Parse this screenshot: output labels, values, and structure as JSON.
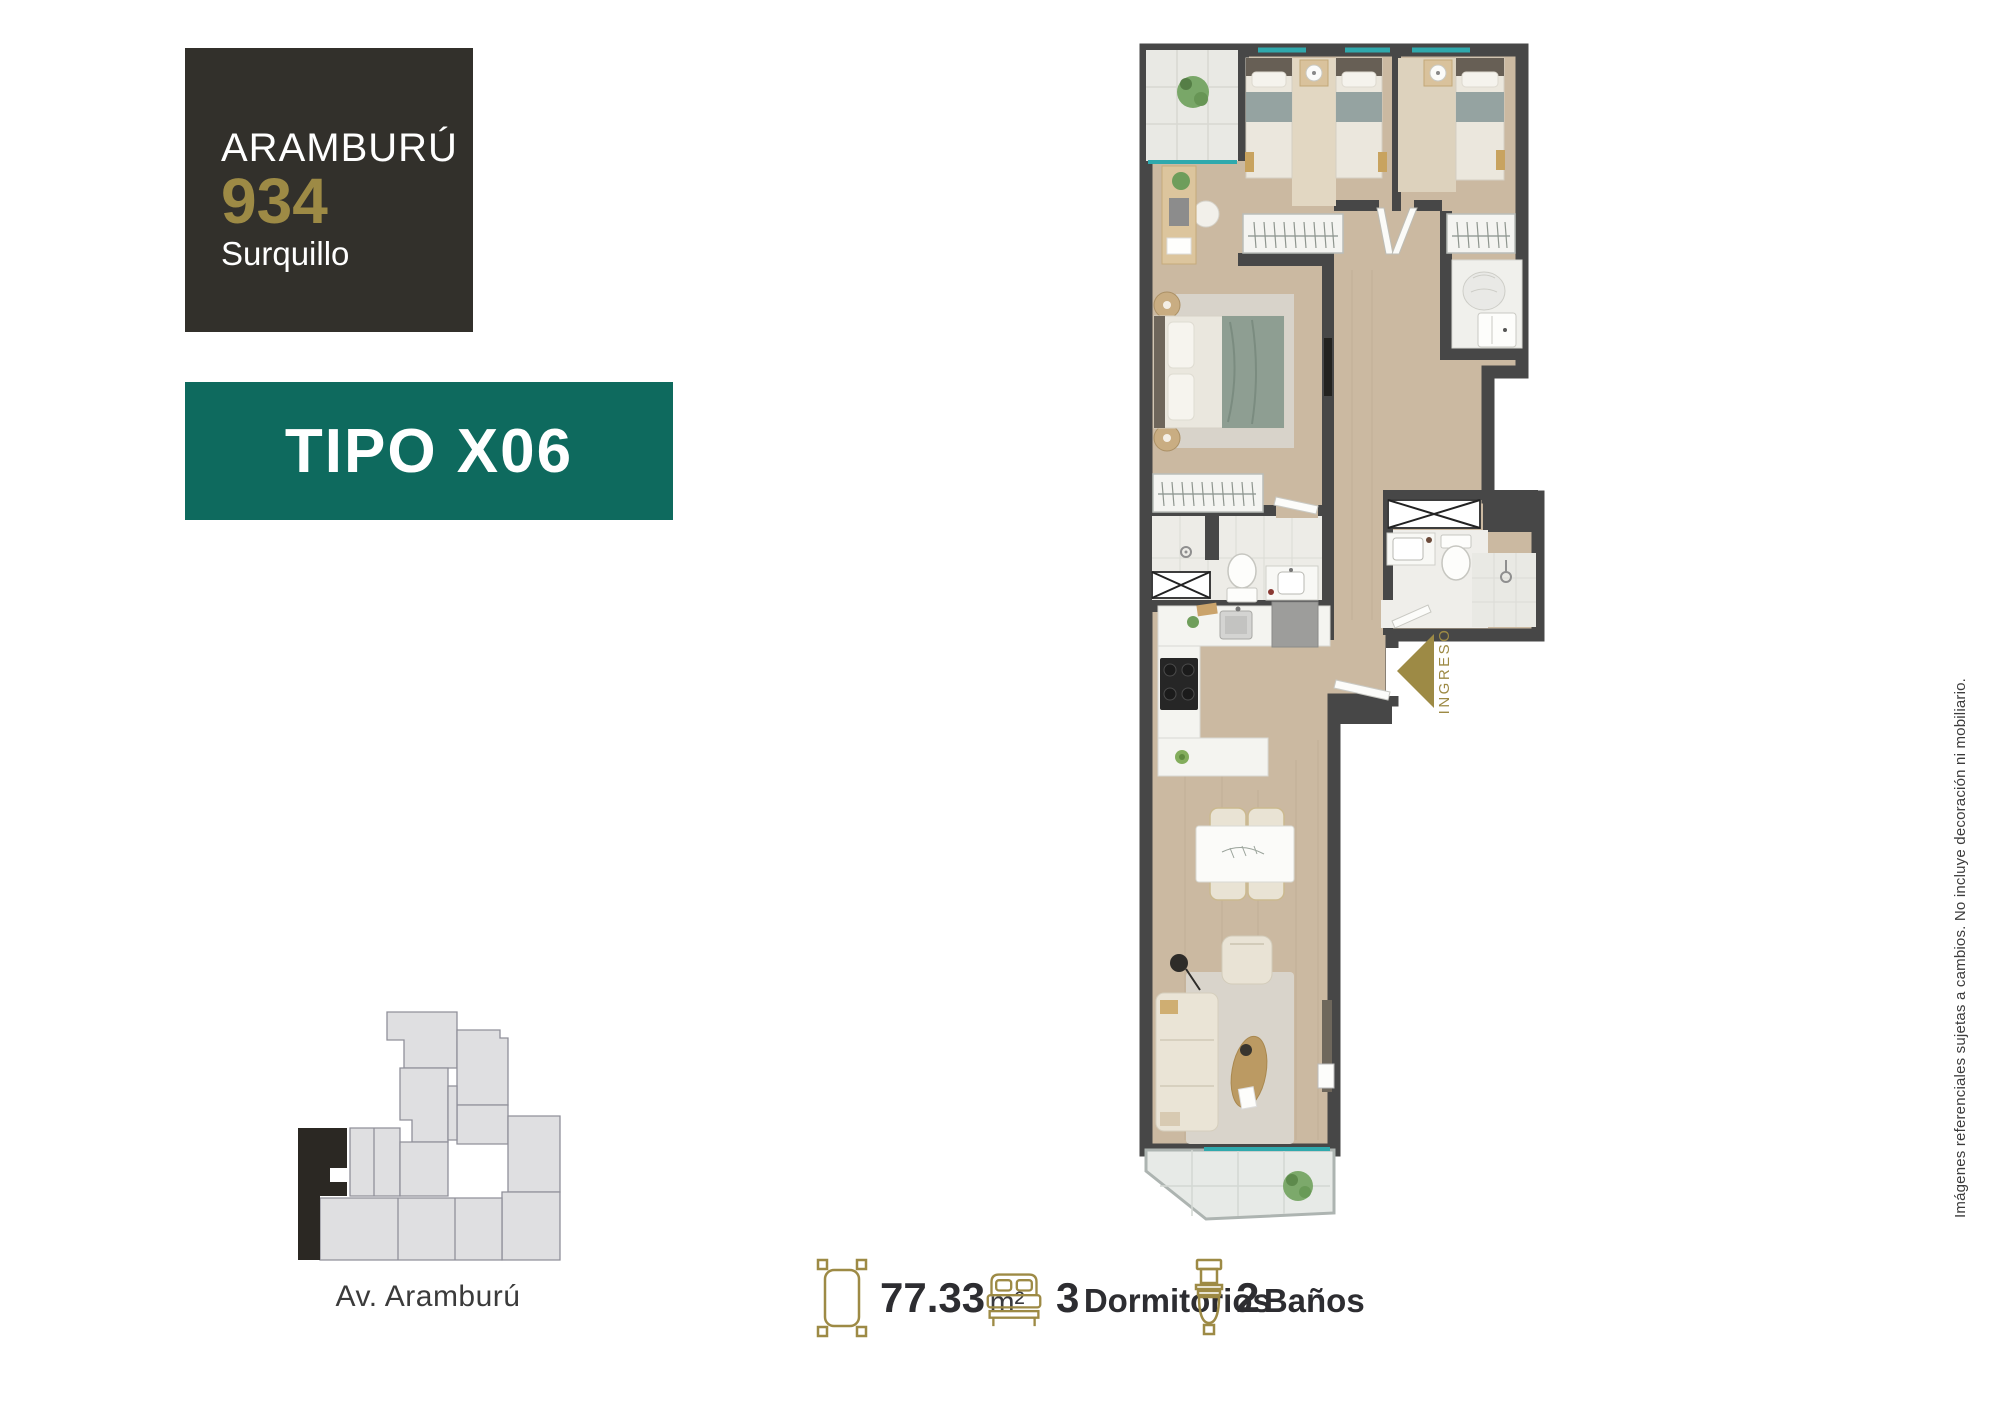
{
  "brand": {
    "name": "ARAMBURÚ",
    "number": "934",
    "district": "Surquillo"
  },
  "unit": {
    "type_label": "TIPO X06"
  },
  "site_map": {
    "street_label": "Av. Aramburú"
  },
  "floorplan": {
    "entrance_label": "INGRESO"
  },
  "stats": {
    "area": {
      "value": "77.33",
      "unit": "m²"
    },
    "bedrooms": {
      "value": "3",
      "label": "Dormitorios"
    },
    "bathrooms": {
      "value": "2",
      "label": "Baños"
    }
  },
  "disclaimer": "Imágenes referenciales sujetas a cambios. No incluye decoración ni mobiliario.",
  "colors": {
    "gold": "#9d8a45",
    "teal": "#0e6a5e",
    "brand_dark": "#32302b",
    "wall": "#474747",
    "wood": "#cbb9a1",
    "glass": "#2fa9ad",
    "text_dark": "#2d2d31"
  }
}
